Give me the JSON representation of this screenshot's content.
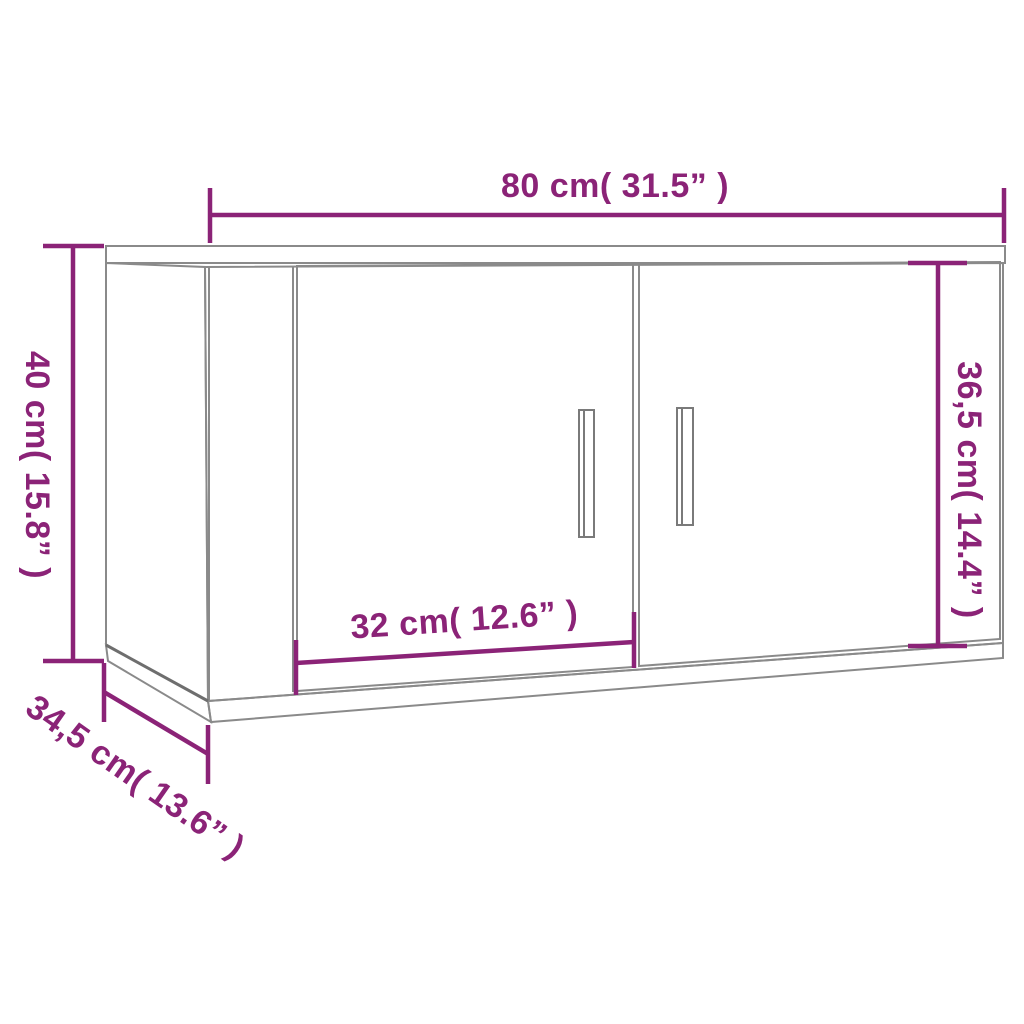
{
  "diagram": {
    "colors": {
      "dimension_purple": "#8B2377",
      "outline_gray": "#8A8A8A",
      "edge_dark_gray": "#6E6E6E",
      "background": "#FFFFFF"
    },
    "dims": {
      "width": "80 cm( 31.5” )",
      "height": "40 cm( 15.8” )",
      "door_height": "36,5 cm( 14.4” )",
      "door_width": "32 cm( 12.6” )",
      "depth": "34,5 cm( 13.6” )"
    }
  }
}
